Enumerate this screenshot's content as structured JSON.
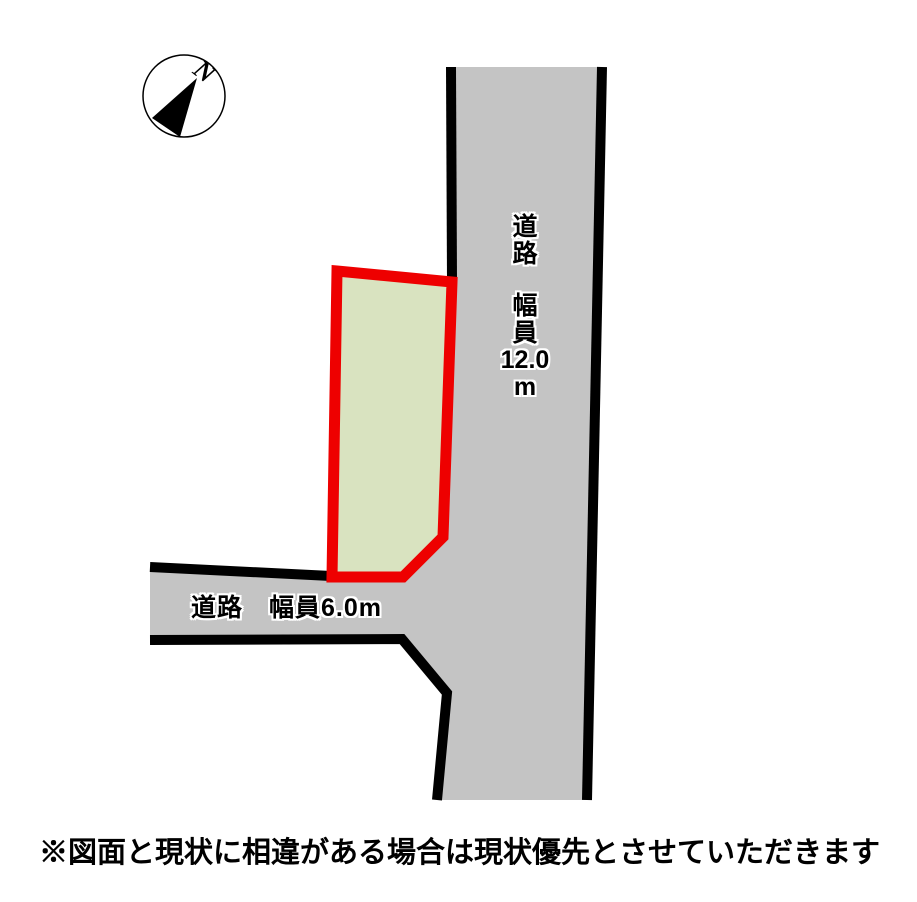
{
  "diagram": {
    "type": "land-plot-site-plan",
    "background_color": "#ffffff"
  },
  "compass": {
    "north_label": "N"
  },
  "roads": {
    "vertical": {
      "label_lines": [
        "道",
        "路",
        "幅",
        "員",
        "12.0",
        "m"
      ],
      "full_label": "道路 幅員 12.0m",
      "fill_color": "#c4c4c4",
      "border_color": "#000000"
    },
    "horizontal": {
      "label": "道路　幅員6.0m",
      "fill_color": "#c4c4c4",
      "border_color": "#000000"
    }
  },
  "parcel": {
    "fill_color": "#d9e3c0",
    "outline_color": "#ee0000"
  },
  "disclaimer": "※図面と現状に相違がある場合は現状優先とさせていただきます"
}
